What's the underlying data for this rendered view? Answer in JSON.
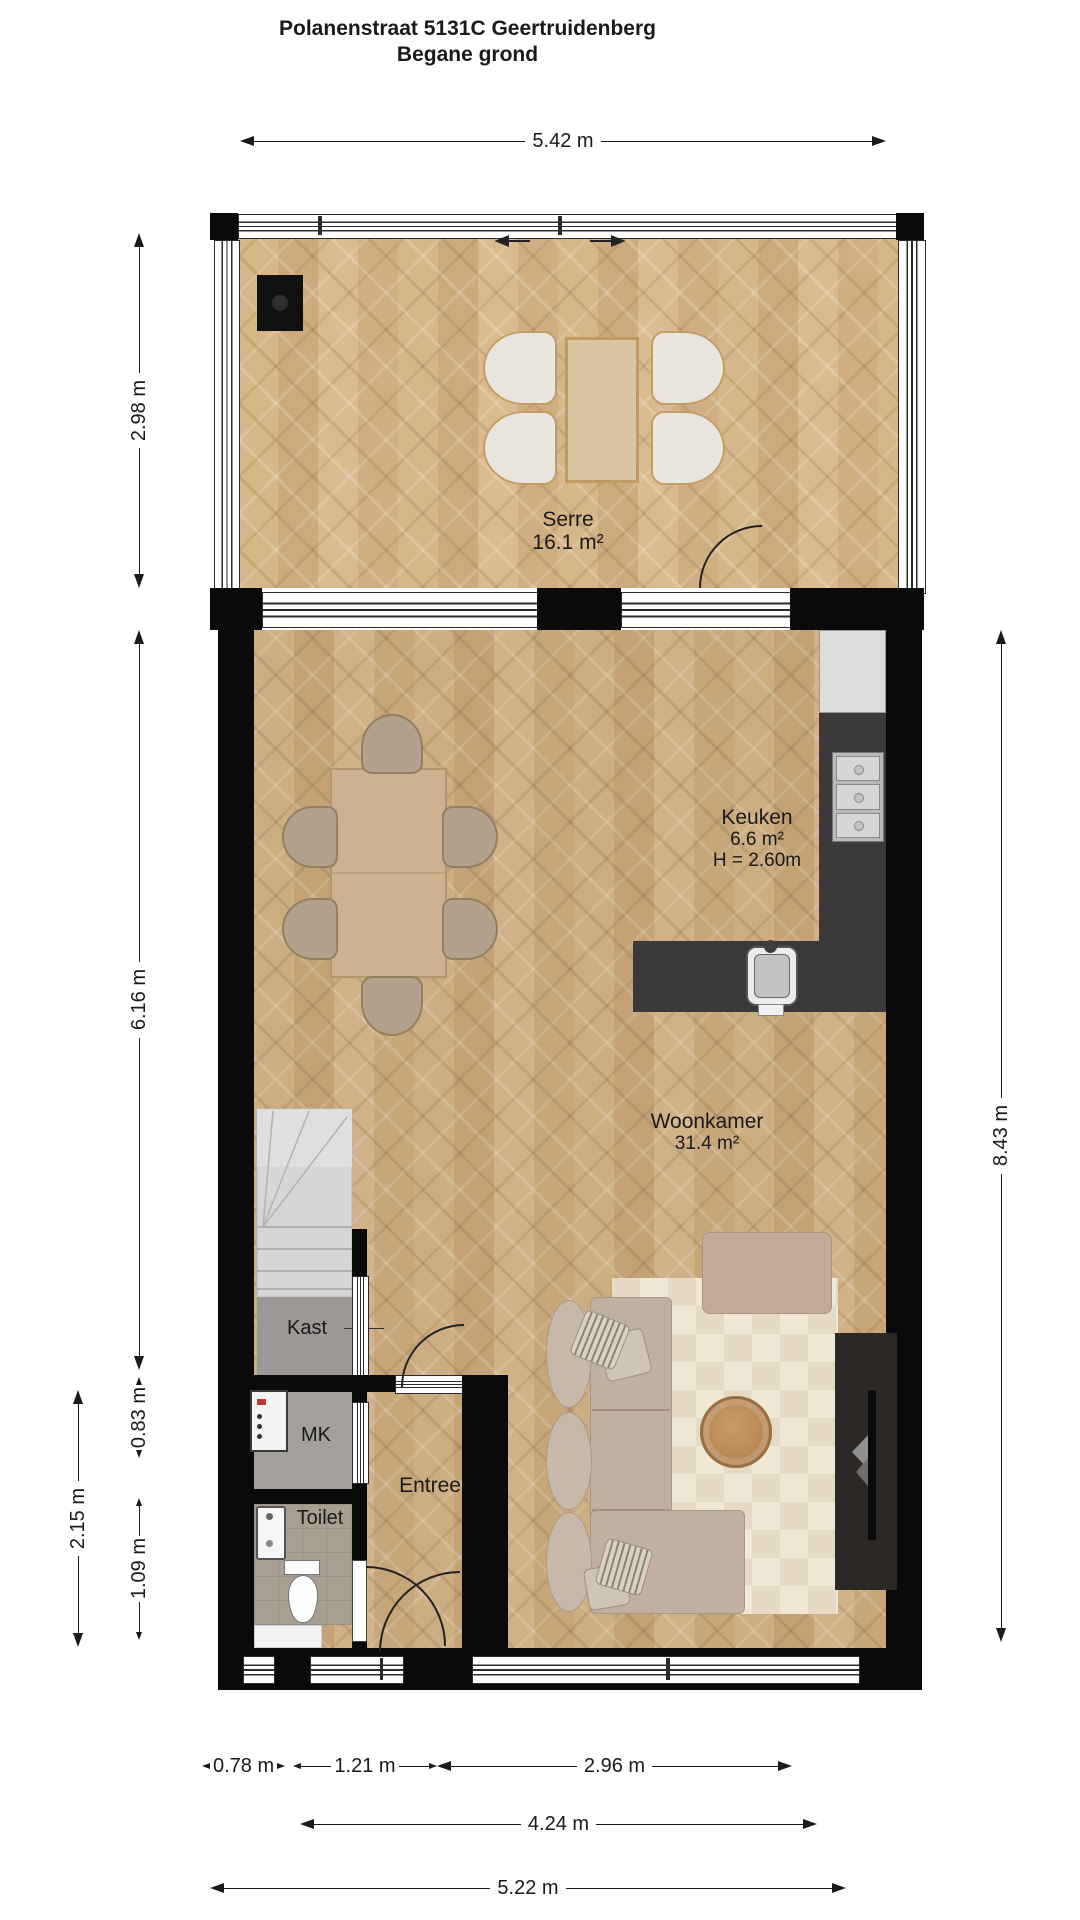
{
  "title": {
    "line1": "Polanenstraat 5131C Geertruidenberg",
    "line2": "Begane grond"
  },
  "rooms": {
    "serre": {
      "name": "Serre",
      "area": "16.1 m²"
    },
    "keuken": {
      "name": "Keuken",
      "area": "6.6 m²",
      "ceiling": "H = 2.60m"
    },
    "woonkamer": {
      "name": "Woonkamer",
      "area": "31.4 m²"
    },
    "kast": {
      "name": "Kast"
    },
    "mk": {
      "name": "MK"
    },
    "toilet": {
      "name": "Toilet"
    },
    "entree": {
      "name": "Entree"
    }
  },
  "dims": {
    "top": "5.42 m",
    "serre_h": "2.98 m",
    "main_h": "6.16 m",
    "mk_h": "0.83 m",
    "toilet_h": "1.09 m",
    "outer_h": "2.15 m",
    "right_h": "8.43 m",
    "b_toilet": "0.78 m",
    "b_entree": "1.21 m",
    "b_woon": "2.96 m",
    "b_mid": "4.24 m",
    "b_full": "5.22 m"
  },
  "colors": {
    "wall": "#0a0a0a",
    "text": "#1a1a1a",
    "floor": "#c9a87c",
    "counter": "#3b393b",
    "appliance": "#dcdcdc",
    "stairs": "#d6d6d6",
    "service-floor": "#a3a09b",
    "toilet-floor": "#a89e92",
    "rug": "#efe8d5",
    "rug-alt": "#e5dac3",
    "sofa": "#bfb0a1",
    "ottoman": "#c2ac99",
    "table-wood": "#cdb190",
    "tv-unit": "#2b2826"
  }
}
